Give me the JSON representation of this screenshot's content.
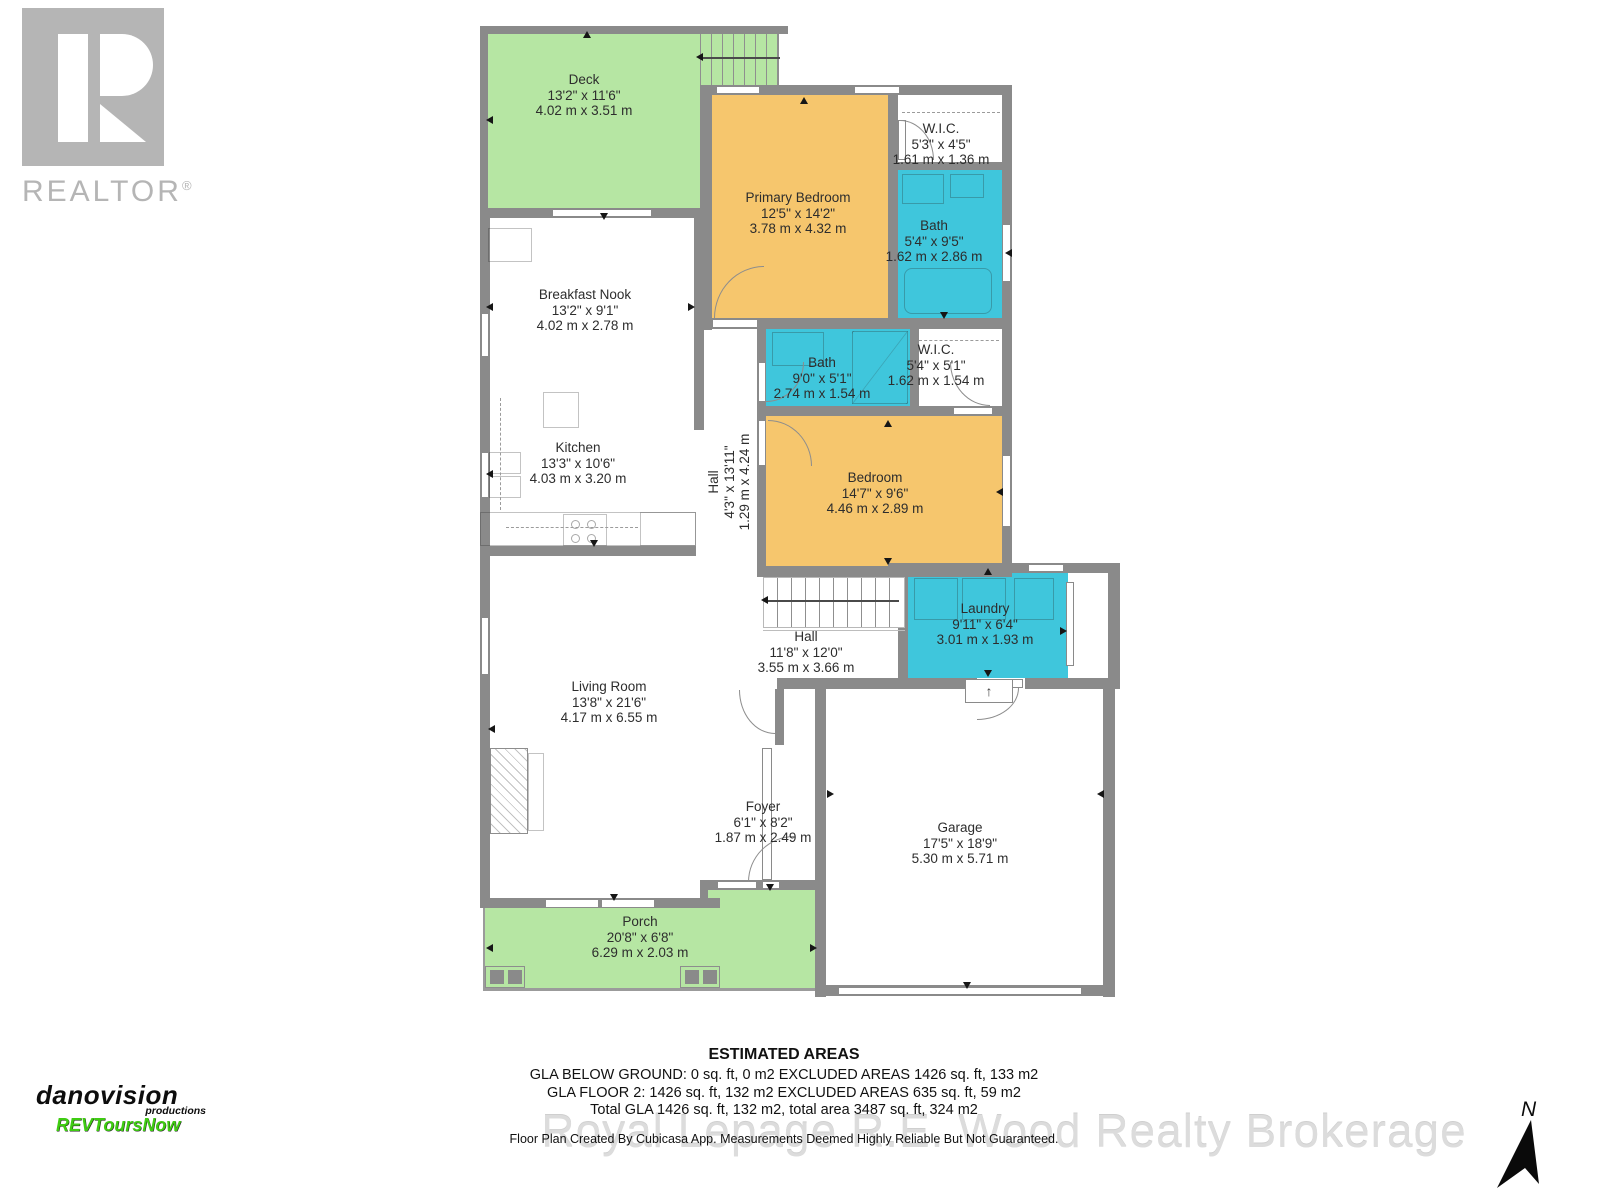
{
  "palette": {
    "room_green": "#b6e6a3",
    "room_orange": "#f6c66d",
    "room_cyan": "#3fc6dc",
    "wall_gray": "#8a8a8a",
    "logo_gray": "#b5b5b5",
    "brand_green": "#3fcc12",
    "watermark_gray": "#dcdcdc"
  },
  "rooms": {
    "deck": {
      "name": "Deck",
      "imperial": "13'2\" x 11'6\"",
      "metric": "4.02 m x 3.51 m"
    },
    "primary_bedroom": {
      "name": "Primary Bedroom",
      "imperial": "12'5\" x 14'2\"",
      "metric": "3.78 m x 4.32 m"
    },
    "wic_primary": {
      "name": "W.I.C.",
      "imperial": "5'3\" x 4'5\"",
      "metric": "1.61 m x 1.36 m"
    },
    "bath_primary": {
      "name": "Bath",
      "imperial": "5'4\" x 9'5\"",
      "metric": "1.62 m x 2.86 m"
    },
    "breakfast_nook": {
      "name": "Breakfast Nook",
      "imperial": "13'2\" x 9'1\"",
      "metric": "4.02 m x 2.78 m"
    },
    "kitchen": {
      "name": "Kitchen",
      "imperial": "13'3\" x 10'6\"",
      "metric": "4.03 m x 3.20 m"
    },
    "hall_upper": {
      "name": "Hall",
      "imperial": "4'3\" x 13'11\"",
      "metric": "1.29 m x 4.24 m"
    },
    "bath_main": {
      "name": "Bath",
      "imperial": "9'0\" x 5'1\"",
      "metric": "2.74 m x 1.54 m"
    },
    "wic_bedroom": {
      "name": "W.I.C.",
      "imperial": "5'4\" x 5'1\"",
      "metric": "1.62 m x 1.54 m"
    },
    "bedroom": {
      "name": "Bedroom",
      "imperial": "14'7\" x 9'6\"",
      "metric": "4.46 m x 2.89 m"
    },
    "laundry": {
      "name": "Laundry",
      "imperial": "9'11\" x 6'4\"",
      "metric": "3.01 m x 1.93 m"
    },
    "hall_lower": {
      "name": "Hall",
      "imperial": "11'8\" x 12'0\"",
      "metric": "3.55 m x 3.66 m"
    },
    "living_room": {
      "name": "Living Room",
      "imperial": "13'8\" x 21'6\"",
      "metric": "4.17 m x 6.55 m"
    },
    "foyer": {
      "name": "Foyer",
      "imperial": "6'1\" x 8'2\"",
      "metric": "1.87 m x 2.49 m"
    },
    "garage": {
      "name": "Garage",
      "imperial": "17'5\" x 18'9\"",
      "metric": "5.30 m x 5.71 m"
    },
    "porch": {
      "name": "Porch",
      "imperial": "20'8\" x 6'8\"",
      "metric": "6.29 m x 2.03 m"
    }
  },
  "footer": {
    "title": "ESTIMATED AREAS",
    "line1": "GLA BELOW GROUND: 0 sq. ft, 0 m2 EXCLUDED AREAS 1426 sq. ft, 133 m2",
    "line2": "GLA FLOOR 2: 1426 sq. ft, 132 m2 EXCLUDED AREAS 635 sq. ft, 59 m2",
    "line3": "Total GLA 1426 sq. ft, 132 m2, total area 3487 sq. ft, 324 m2",
    "disclaimer": "Floor Plan Created By Cubicasa App. Measurements Deemed Highly Reliable But Not Guaranteed."
  },
  "watermark": "Royal Lepage R.E. Wood Realty Brokerage",
  "logos": {
    "realtor": {
      "brand": "REALTOR",
      "registered": "®"
    },
    "danovision": {
      "line1": "danovision",
      "line2": "productions",
      "line3": "REVToursNow"
    }
  },
  "compass": {
    "label": "N"
  },
  "stairs": {
    "step_arrow": "↑"
  }
}
